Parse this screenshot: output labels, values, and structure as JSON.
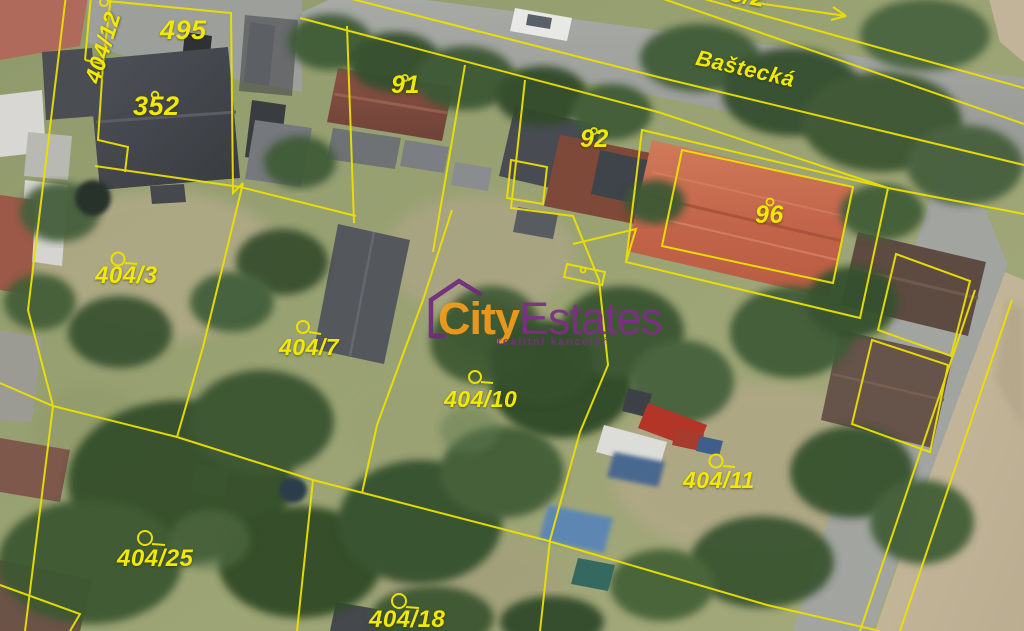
{
  "map": {
    "type": "aerial-cadastral-view",
    "street_label": "Baštecká",
    "partial_label_top": "3/2",
    "line_color": "#ece000",
    "label_color": "#f2e800"
  },
  "parcels": [
    {
      "label": "404/12"
    },
    {
      "label": "495"
    },
    {
      "label": "352"
    },
    {
      "label": "91"
    },
    {
      "label": "92"
    },
    {
      "label": "96"
    },
    {
      "label": "404/3"
    },
    {
      "label": "404/7"
    },
    {
      "label": "404/10"
    },
    {
      "label": "404/11"
    },
    {
      "label": "404/25"
    },
    {
      "label": "404/18"
    }
  ],
  "watermark": {
    "brand_prefix": "City",
    "brand_suffix": "Estates",
    "tagline": "realitní kancelář",
    "prefix_color": "#f59d1c",
    "suffix_color": "#7c2f86"
  }
}
